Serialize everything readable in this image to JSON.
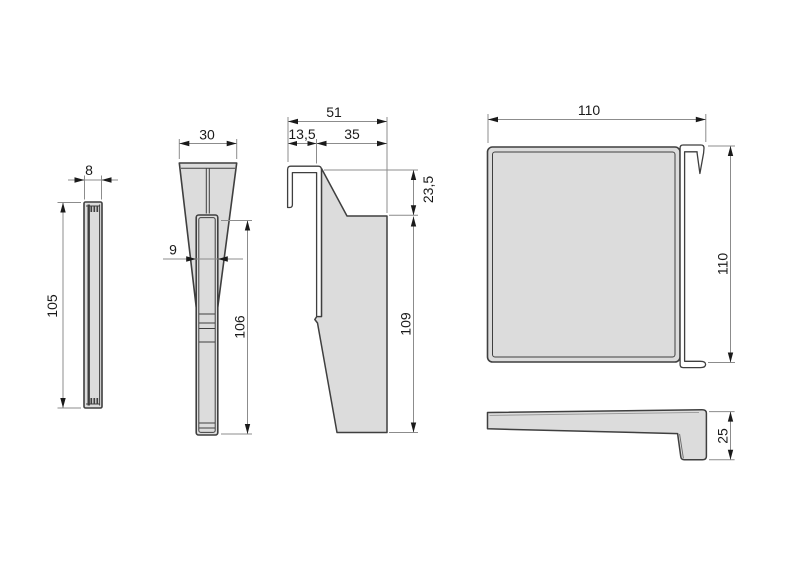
{
  "drawing": {
    "colors": {
      "background": "#ffffff",
      "part_fill": "#dcdcdc",
      "part_outline": "#3f3f3f",
      "dimension_line": "#8c8c8c",
      "label_text": "#1a1a1a"
    },
    "dims": {
      "profile_width": "8",
      "profile_height": "105",
      "wedge_top_width": "30",
      "stem_width": "9",
      "stem_height": "106",
      "bracket_total_width": "51",
      "bracket_hook_width": "13,5",
      "bracket_body_width": "35",
      "bracket_top_height": "23,5",
      "bracket_body_height": "109",
      "panel_width": "110",
      "panel_height": "110",
      "panel_edge_height": "25"
    }
  }
}
